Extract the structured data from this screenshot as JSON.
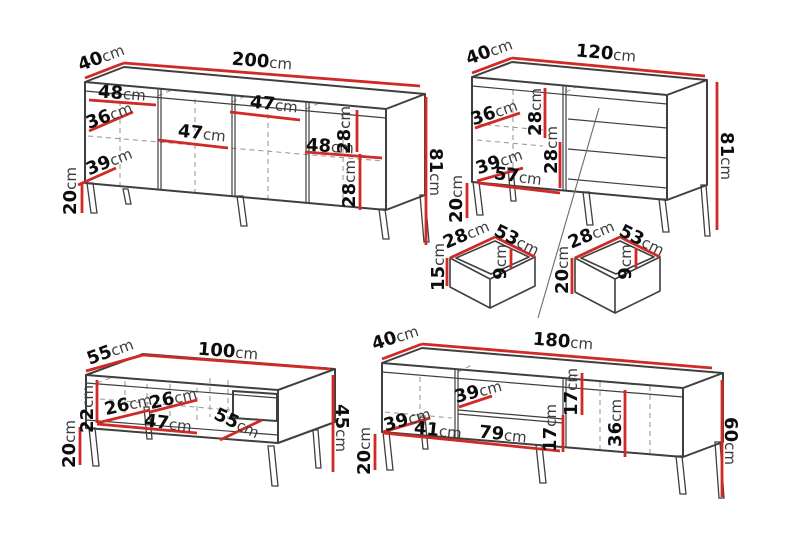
{
  "colors": {
    "background": "#ffffff",
    "dimension_line": "#cf2a26",
    "outline": "#3f3f3f",
    "dashed_line": "#9b9b9b",
    "label_number": "#0d0d0d",
    "label_unit": "#3c3c3c"
  },
  "sideboard_200": {
    "depth": "40cm",
    "width": "200cm",
    "height": "81cm",
    "leg": "20cm",
    "door1": "48cm",
    "shelf": "36cm",
    "base": "39cm",
    "door2": "47cm",
    "door3": "47cm",
    "door4": "48cm",
    "gap_top": "28cm",
    "gap_bottom": "28cm"
  },
  "sideboard_120": {
    "depth": "40cm",
    "width": "120cm",
    "height": "81cm",
    "leg": "20cm",
    "shelf": "36cm",
    "gap_top": "28cm",
    "gap_bottom": "28cm",
    "base": "39cm",
    "door": "57cm"
  },
  "drawer_small": {
    "depth": "28cm",
    "width": "53cm",
    "height": "15cm",
    "inner": "9cm"
  },
  "drawer_large": {
    "depth": "28cm",
    "width": "53cm",
    "height": "20cm",
    "inner": "9cm"
  },
  "coffee_table": {
    "depth": "55cm",
    "width": "100cm",
    "height": "45cm",
    "leg": "20cm",
    "opening": "22cm",
    "compartment1": "26cm",
    "compartment2": "26cm",
    "inner_width": "47cm",
    "inner_depth": "55cm"
  },
  "tv_stand": {
    "depth": "40cm",
    "width": "180cm",
    "height": "60cm",
    "leg": "20cm",
    "shelf": "39cm",
    "inner_depth": "39cm",
    "left": "41cm",
    "middle": "79cm",
    "gap_top": "17cm",
    "gap_bottom": "17cm",
    "door": "36cm"
  }
}
